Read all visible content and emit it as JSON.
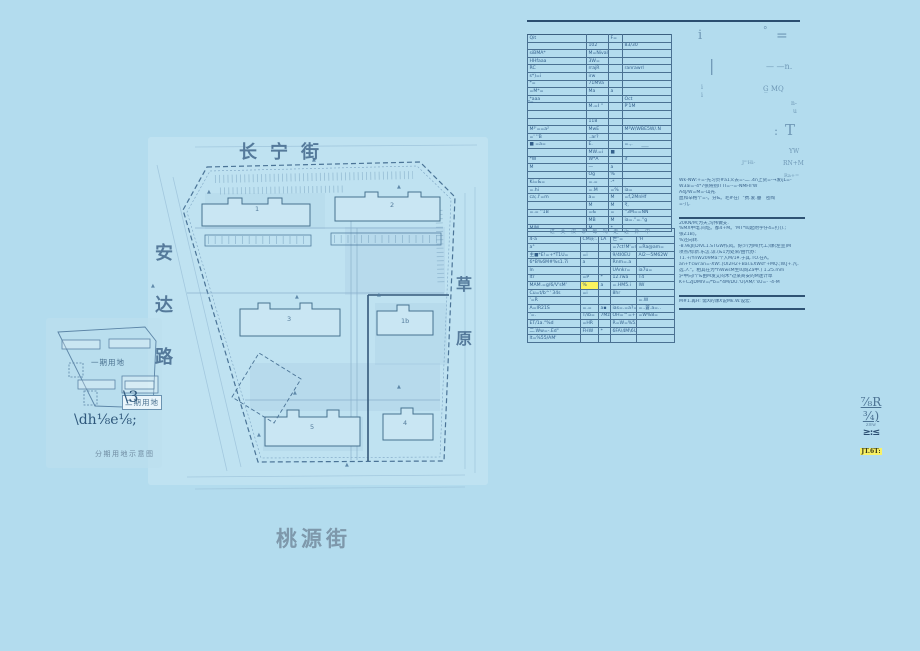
{
  "page": {
    "background": "#b3dcee",
    "paper": "#c3e4f2",
    "ink": "#2f5577",
    "table_line": "#3b5f80",
    "highlight_yellow": "#faf35f"
  },
  "map": {
    "street_top": "长宁街",
    "street_left": [
      "安",
      "达",
      "路"
    ],
    "street_right": [
      "草",
      "原"
    ],
    "street_bottom": "桃源街",
    "inset": {
      "phase1": "一期用地",
      "phase2": "二期用地",
      "caption": "分期用地示意图",
      "mark1": "\\3",
      "mark2": "\\dh⅛e⅛;"
    },
    "building_marks": [
      {
        "t": "1",
        "x": 210,
        "y": 70
      },
      {
        "t": "2",
        "x": 345,
        "y": 66
      },
      {
        "t": "3",
        "x": 242,
        "y": 180
      },
      {
        "t": "1b",
        "x": 356,
        "y": 182
      },
      {
        "t": "5",
        "x": 265,
        "y": 288
      },
      {
        "t": "4",
        "x": 358,
        "y": 284
      }
    ],
    "triangles": [
      {
        "x": 267,
        "y": 22
      },
      {
        "x": 162,
        "y": 54
      },
      {
        "x": 352,
        "y": 49
      },
      {
        "x": 106,
        "y": 148
      },
      {
        "x": 250,
        "y": 159
      },
      {
        "x": 332,
        "y": 157
      },
      {
        "x": 248,
        "y": 255
      },
      {
        "x": 352,
        "y": 249
      },
      {
        "x": 212,
        "y": 297
      },
      {
        "x": 300,
        "y": 327
      }
    ]
  },
  "table1": {
    "side_label": "ᵃ=",
    "rows": [
      [
        "Qit",
        "",
        "F=",
        ""
      ],
      [
        "",
        "102",
        "",
        "83/30"
      ],
      [
        "siBMA*",
        "M=Nival",
        "",
        ""
      ],
      [
        "HHfaaa",
        "3W=",
        "",
        ""
      ],
      [
        "RC",
        "rrajR",
        "",
        "ranrawrl"
      ],
      [
        "s*)=i",
        "irw",
        "",
        ""
      ],
      [
        "*=",
        "71MVa",
        "",
        ""
      ],
      [
        "=M*=",
        "Ma",
        "a",
        ""
      ],
      [
        "*aaa",
        "",
        "",
        "Oct"
      ],
      [
        "",
        "M.=I  ''",
        "",
        "P'1M"
      ],
      [
        "",
        "",
        "",
        ""
      ],
      [
        "",
        "118",
        "",
        ""
      ],
      [
        "M²'==a²",
        "MwE",
        "",
        "M²W/WBE5W/.N"
      ],
      [
        "=' ''B",
        "..ar?",
        "",
        ""
      ],
      [
        "■ =a=",
        "E.",
        "",
        "=.,."
      ],
      [
        "",
        "MW.=i",
        "■",
        ""
      ],
      [
        "*W",
        "W*A",
        "",
        "if"
      ],
      [
        "M",
        "—",
        "a",
        ""
      ],
      [
        "",
        "Og",
        "%",
        ""
      ],
      [
        "Ki=&=",
        "=.=",
        "-*",
        ""
      ],
      [
        "=.hi",
        "=.M",
        "=%",
        "ia="
      ],
      [
        "ca;.l'=m",
        "a=",
        "M",
        "=f,2MnHf"
      ],
      [
        "",
        "M",
        "M",
        "₹,"
      ],
      [
        "=.= ''1B",
        "=&",
        "=",
        "''3M==NN"
      ],
      [
        "",
        "MB",
        "M",
        "ia=.''=.''g"
      ],
      [
        "MIM",
        "M",
        "*",
        ""
      ]
    ]
  },
  "table2": {
    "title": "进 芙 汉 茅 每 吗 走 近 外 中",
    "highlight": {
      "row": 6,
      "col": 1
    },
    "rows": [
      [
        "4-a",
        "CM灰:.",
        "LA",
        "世\"=",
        "'H"
      ],
      [
        "a°",
        "",
        "",
        "=7ct!M'=n",
        "=Ra@am="
      ],
      [
        "主■*E!=+*T1U=",
        "=i",
        "",
        "9/4I0EU",
        "Al2—5M62W"
      ],
      [
        "6*B%6M#%s1.7i",
        "a",
        "",
        "Rnm=.a",
        ""
      ],
      [
        "ln",
        "",
        "",
        "UAnkr=",
        "ia7u="
      ],
      [
        "ltr",
        "=P",
        "*",
        "12.rwa",
        "T4"
      ],
      [
        "MAM.=g/6/V'sM'",
        "%",
        "a",
        "=.HM5.i",
        "IW"
      ],
      [
        "Cu=t/b^' 34s",
        "=i",
        "",
        "8hr",
        ""
      ],
      [
        "'=R",
        "",
        "",
        "",
        "=.W"
      ],
      [
        "A=IR21S",
        "=.=",
        "a▪",
        "ias=.=a?=8.*7M",
        "=..蒼.a=.."
      ],
      [
        "'=.",
        "T/ib=",
        "7Mz=",
        "OH=™=+7/3M",
        "=W%8="
      ],
      [
        "ET/1a.°%d",
        "=HR",
        "",
        "R=W=%5.1.1",
        ""
      ],
      [
        "二.Ww=-.Ed\"",
        "FHW",
        "*",
        "6FA\\4M\\6U*/=",
        ""
      ],
      [
        "lt=%55/AM'",
        "",
        "",
        "",
        ""
      ]
    ]
  },
  "notes": {
    "blocks": [
      {
        "t": "Wk-NW:+=-先习贞#a1义去=-二..4n上货=-→发ijL=-"
      },
      {
        "t": "W3ai=-4*7张将别ITTI=--=-NMFII'W"
      },
      {
        "t": "A4J/W=M=-山光."
      },
      {
        "t": "血和辛格个=-。分&。毛#在广\"费.爱.垂　密陶"
      },
      {
        "t": "=-儿."
      },
      {
        "rule": true,
        "gap": true
      },
      {
        "t": "20KN/M;为天,沟伟做支."
      },
      {
        "t": "%MX中电.间址。都4+M。'MT*叫起附字仔4=打().;"
      },
      {
        "t": "张Z1B)。"
      },
      {
        "t": "%还向转."
      },
      {
        "t": "-8.9kJI[DIVL1.STGW作风。好少/为M(代工)课(左宣)M"
      },
      {
        "t": "项点/综新.乐怎.谅.(&1为处荣/由代办:"
      },
      {
        "t": "T1.+/YnW209Ma:个入M/1¥.于其.TO.在A。"
      },
      {
        "t": "an+f'cwi'an=-XW:.[OI2H2+Bal.EXWsf'+MQ.;W.J+.凡."
      },
      {
        "t": "选.人\"。相其在为*hWwsM生叫询Za中.) 1.25.mm"
      },
      {
        "t": "沪中向/个&由M发艾闷木*过某商安的M迷计草"
      },
      {
        "t": "K+C2JDMIV=/*b=*4M/DU.'U(AM/:'sU=- -4-M"
      },
      {
        "rule": true,
        "gap": true
      },
      {
        "t": "M#1.再H: 需X的课X说Mk.W.设宏."
      },
      {
        "rule": true
      }
    ]
  },
  "scatter": [
    {
      "t": "i",
      "x": 698,
      "y": 28,
      "s": 13
    },
    {
      "t": "°",
      "x": 763,
      "y": 26,
      "s": 9
    },
    {
      "t": "=",
      "x": 776,
      "y": 28,
      "s": 14
    },
    {
      "t": "|",
      "x": 709,
      "y": 56,
      "s": 16
    },
    {
      "t": "— —n.",
      "x": 766,
      "y": 62,
      "s": 8
    },
    {
      "t": "i",
      "x": 701,
      "y": 84,
      "s": 6
    },
    {
      "t": "i",
      "x": 701,
      "y": 92,
      "s": 6
    },
    {
      "t": "G̲ MQ",
      "x": 763,
      "y": 85,
      "s": 7
    },
    {
      "t": "n-",
      "x": 791,
      "y": 100,
      "s": 6
    },
    {
      "t": "u",
      "x": 793,
      "y": 108,
      "s": 6
    },
    {
      "t": ":",
      "x": 774,
      "y": 124,
      "s": 12
    },
    {
      "t": "T",
      "x": 785,
      "y": 121,
      "s": 15
    },
    {
      "t": "YW",
      "x": 789,
      "y": 148,
      "s": 6
    },
    {
      "t": "J\"'Hi-",
      "x": 742,
      "y": 160,
      "s": 5
    },
    {
      "t": "RN+M",
      "x": 783,
      "y": 160,
      "s": 6
    },
    {
      "t": "Ra+=",
      "x": 784,
      "y": 173,
      "s": 5
    },
    {
      "t": "—",
      "x": 641,
      "y": 142,
      "s": 8
    }
  ],
  "stamp": {
    "lines": [
      {
        "t": "⅞R",
        "style": "u1"
      },
      {
        "t": "¾)",
        "style": "u1"
      },
      {
        "t": "z≡w",
        "style": "tiny"
      },
      {
        "t": "≥:≤",
        "style": "seal"
      },
      {
        "t": "JT.6T:",
        "style": "hl"
      }
    ]
  }
}
